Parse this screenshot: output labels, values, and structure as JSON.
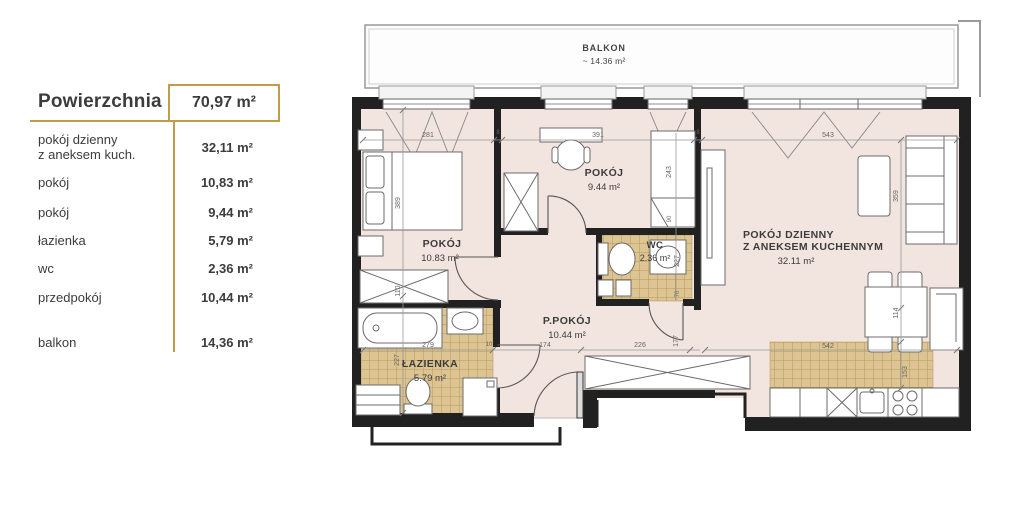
{
  "legend": {
    "title": "Powierzchnia",
    "total": "70,97 m²",
    "rows": [
      {
        "label": "pokój dzienny",
        "label2": "z aneksem kuch.",
        "value": "32,11 m²"
      },
      {
        "label": "pokój",
        "value": "10,83 m²"
      },
      {
        "label": "pokój",
        "value": "9,44 m²"
      },
      {
        "label": "łazienka",
        "value": "5,79 m²"
      },
      {
        "label": "wc",
        "value": "2,36 m²"
      },
      {
        "label": "przedpokój",
        "value": "10,44 m²"
      },
      {
        "label": "balkon",
        "value": "14,36 m²"
      }
    ]
  },
  "plan": {
    "balcony": {
      "name": "BALKON",
      "area": "~ 14.36 m²"
    },
    "rooms": {
      "bedroom": {
        "name": "POKÓJ",
        "area": "10.83 m²"
      },
      "room2": {
        "name": "POKÓJ",
        "area": "9.44 m²"
      },
      "wc": {
        "name": "WC",
        "area": "2.36 m²"
      },
      "hall": {
        "name": "P.POKÓJ",
        "area": "10.44 m²"
      },
      "bath": {
        "name": "ŁAZIENKA",
        "area": "5.79 m²"
      },
      "living": {
        "name1": "POKÓJ DZIENNY",
        "name2": "Z ANEKSEM KUCHENNYM",
        "area": "32.11 m²"
      }
    },
    "dims": {
      "w281": "281",
      "w8a": "8",
      "w391": "391",
      "w8b": "8",
      "w543": "543",
      "h389": "389",
      "h110": "110",
      "h227bath": "227",
      "b279": "279",
      "b10": "10",
      "b174": "174",
      "b226": "226",
      "b177": "177",
      "v243": "243",
      "v90": "90",
      "v227wc": "227",
      "v70": "70",
      "k542": "542",
      "k153": "153",
      "s359": "359",
      "t114": "114"
    },
    "colors": {
      "accent": "#c09b4a",
      "floor": "#f2e4de",
      "tile": "#dcc493",
      "wall": "#212121"
    }
  }
}
